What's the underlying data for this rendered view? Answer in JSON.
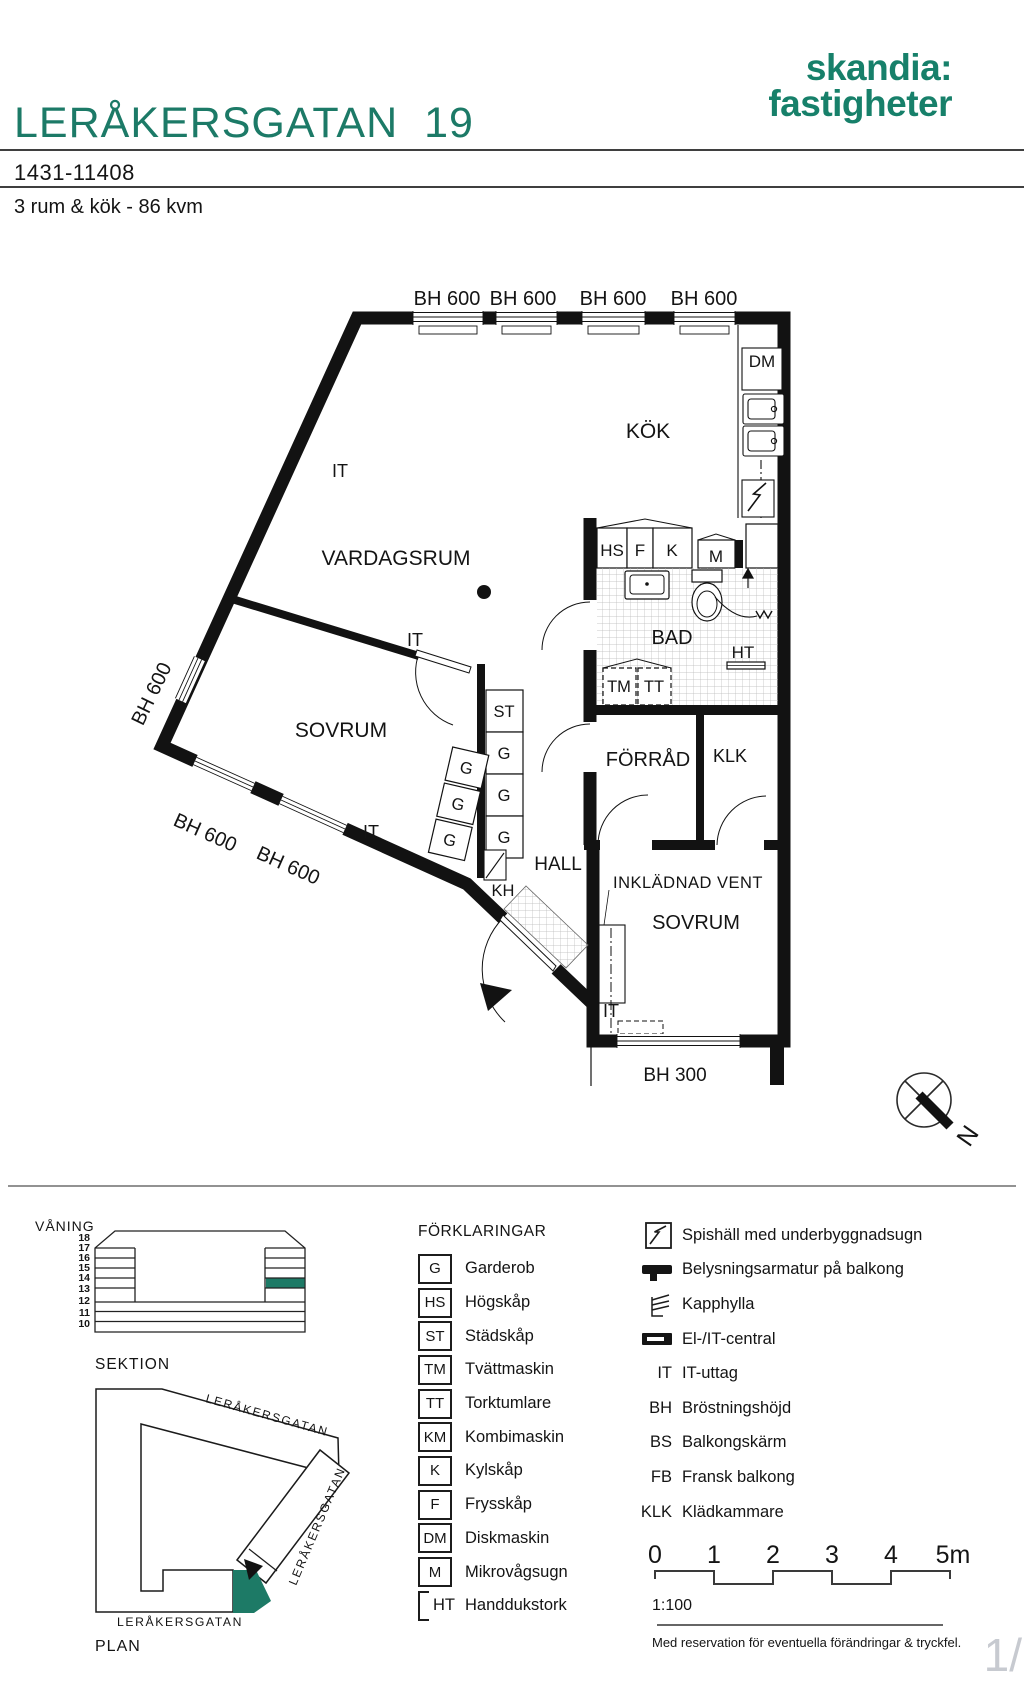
{
  "header": {
    "title": "LERÅKERSGATAN  19",
    "logo_line1": "skandia:",
    "logo_line2": "fastigheter",
    "object_number": "1431-11408",
    "summary": "3 rum & kök - 86 kvm"
  },
  "plan": {
    "rooms": {
      "kok": "KÖK",
      "vardagsrum": "VARDAGSRUM",
      "sovrum": "SOVRUM",
      "sovrum2": "SOVRUM",
      "bad": "BAD",
      "hall": "HALL",
      "forrad": "FÖRRÅD",
      "klk": "KLK"
    },
    "labels": {
      "bh600": "BH 600",
      "bh300": "BH 300",
      "it": "IT",
      "dm": "DM",
      "hs": "HS",
      "f": "F",
      "k": "K",
      "m": "M",
      "tm": "TM",
      "tt": "TT",
      "st": "ST",
      "g": "G",
      "kh": "KH",
      "ht": "HT",
      "inkladnad_vent": "INKLÄDNAD VENT",
      "north": "N"
    }
  },
  "section": {
    "title": "VÅNING",
    "caption": "SEKTION",
    "floors": [
      "18",
      "17",
      "16",
      "15",
      "14",
      "13",
      "12",
      "11",
      "10"
    ],
    "highlighted_floor": "14"
  },
  "site": {
    "caption": "PLAN",
    "street": "LERÅKERSGATAN"
  },
  "legend": {
    "title": "FÖRKLARINGAR",
    "items": [
      {
        "abbr": "G",
        "label": "Garderob"
      },
      {
        "abbr": "HS",
        "label": "Högskåp"
      },
      {
        "abbr": "ST",
        "label": "Städskåp"
      },
      {
        "abbr": "TM",
        "label": "Tvättmaskin"
      },
      {
        "abbr": "TT",
        "label": "Torktumlare"
      },
      {
        "abbr": "KM",
        "label": "Kombimaskin"
      },
      {
        "abbr": "K",
        "label": "Kylskåp"
      },
      {
        "abbr": "F",
        "label": "Frysskåp"
      },
      {
        "abbr": "DM",
        "label": "Diskmaskin"
      },
      {
        "abbr": "M",
        "label": "Mikrovågsugn"
      },
      {
        "abbr": "HT",
        "label": "Handdukstork"
      }
    ],
    "symbols": [
      {
        "icon": "stove-icon",
        "label": "Spishäll med underbyggnadsugn"
      },
      {
        "icon": "balcony-light-icon",
        "label": "Belysningsarmatur på balkong"
      },
      {
        "icon": "coat-rack-icon",
        "label": "Kapphylla"
      },
      {
        "icon": "el-central-icon",
        "label": "El-/IT-central"
      },
      {
        "abbr": "IT",
        "label": "IT-uttag"
      },
      {
        "abbr": "BH",
        "label": "Bröstningshöjd"
      },
      {
        "abbr": "BS",
        "label": "Balkongskärm"
      },
      {
        "abbr": "FB",
        "label": "Fransk balkong"
      },
      {
        "abbr": "KLK",
        "label": "Klädkammare"
      }
    ]
  },
  "scale": {
    "ticks": [
      "0",
      "1",
      "2",
      "3",
      "4",
      "5m"
    ],
    "ratio": "1:100"
  },
  "footer": {
    "disclaimer": "Med reservation för eventuella förändringar & tryckfel.",
    "page_fragment": "1/"
  },
  "colors": {
    "brand_green": "#17806a",
    "highlight_green": "#1d7a66",
    "scale_green": "#2e9479",
    "line_black": "#121212"
  }
}
